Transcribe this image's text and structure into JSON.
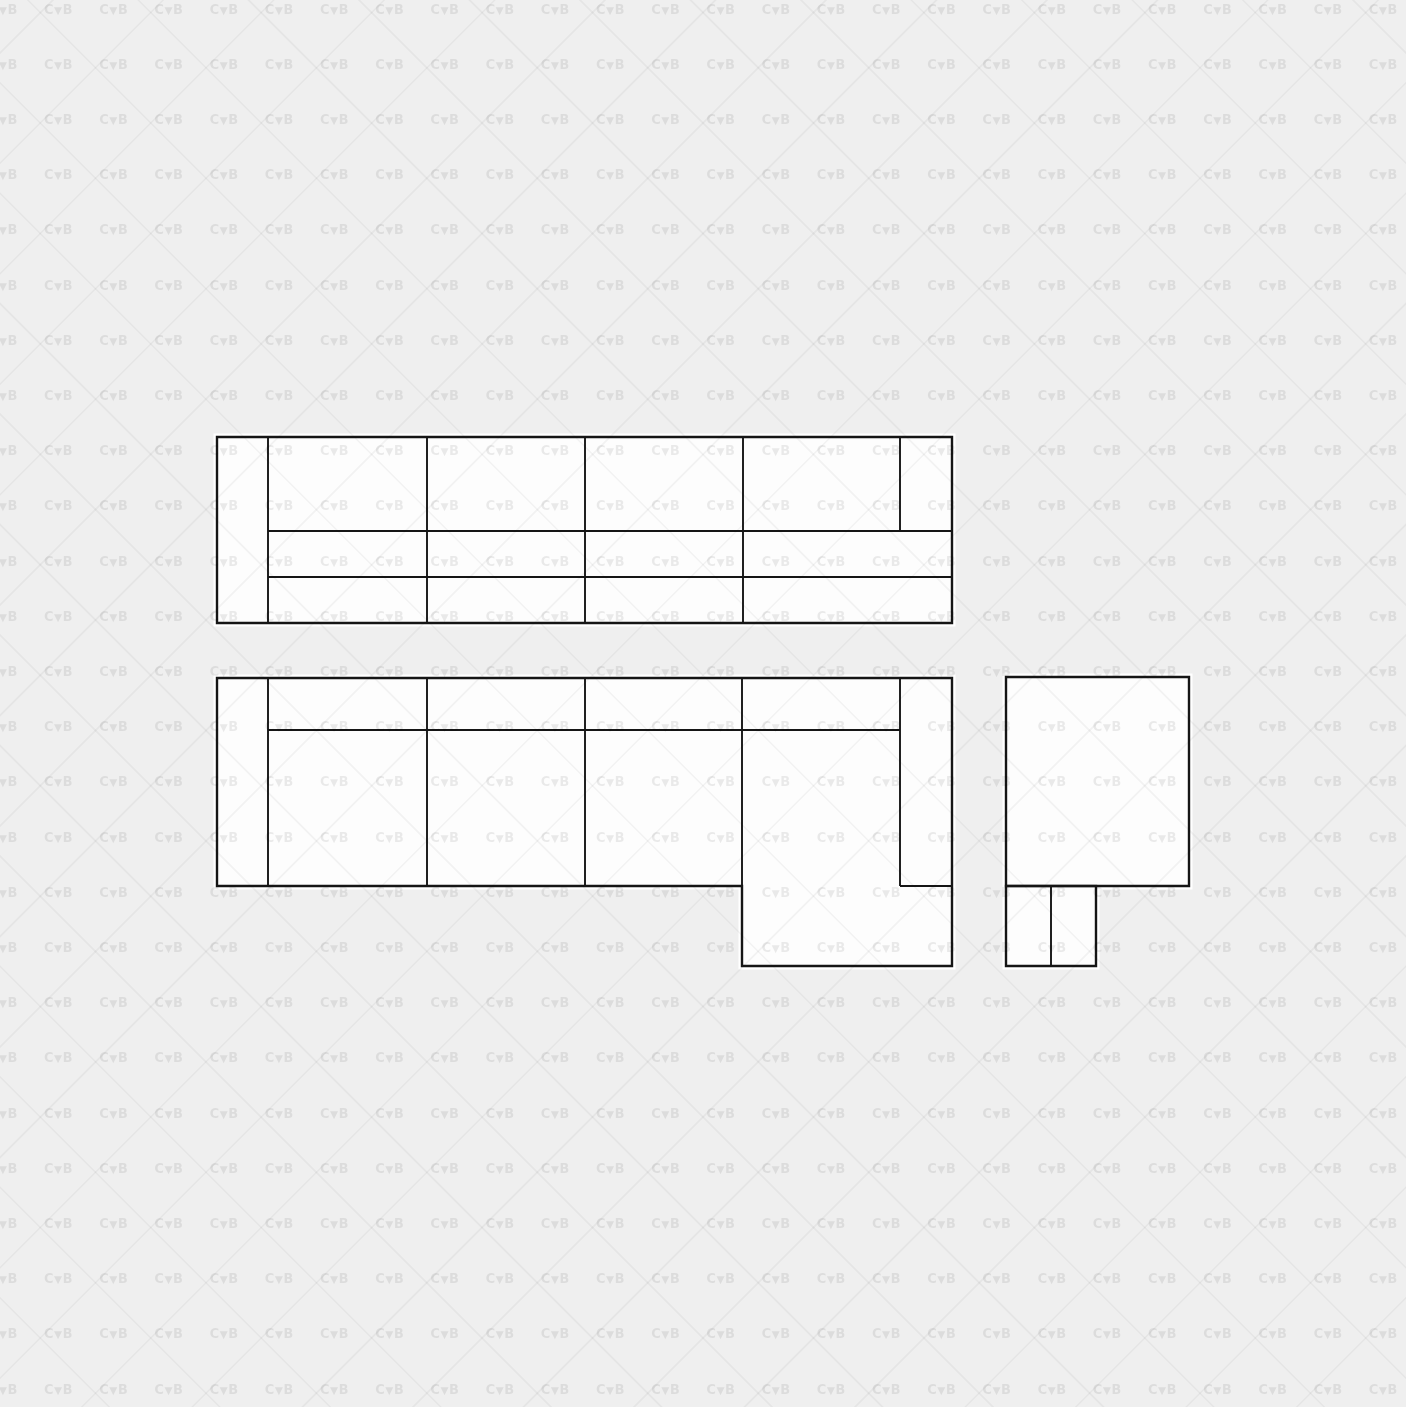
{
  "canvas": {
    "width": 1406,
    "height": 1407,
    "background_color": "#efefef"
  },
  "watermark": {
    "text": "CVB",
    "display_glyphs": [
      "C",
      "▼",
      "B"
    ],
    "text_color": "rgba(0,0,0,0.08)",
    "diagonal_line_color": "rgba(0,0,0,0.042)",
    "tile_size": 55.2,
    "origin_x": -11.2,
    "origin_y": 4.6,
    "diagonal_spacing": 78.1,
    "diagonal_line_width": 1.6
  },
  "drawing": {
    "stroke_color": "#151515",
    "fill_color": "#fdfdfd",
    "halo_color": "#ffffff",
    "outer_stroke_width": 2.4,
    "inner_stroke_width": 1.9,
    "halo_width": 7,
    "blocks": [
      {
        "name": "straight-sofa-top-view",
        "outline": [
          [
            217,
            437
          ],
          [
            952,
            437
          ],
          [
            952,
            623
          ],
          [
            217,
            623
          ]
        ],
        "inner_lines": [
          [
            268,
            437,
            268,
            623
          ],
          [
            427,
            437,
            427,
            623
          ],
          [
            585,
            437,
            585,
            623
          ],
          [
            743,
            437,
            743,
            623
          ],
          [
            900,
            437,
            900,
            531
          ],
          [
            268,
            531,
            952,
            531
          ],
          [
            268,
            577,
            952,
            577
          ]
        ]
      },
      {
        "name": "corner-sofa-chaise-top-view",
        "outline": [
          [
            217,
            678
          ],
          [
            952,
            678
          ],
          [
            952,
            966
          ],
          [
            742,
            966
          ],
          [
            742,
            886
          ],
          [
            217,
            886
          ]
        ],
        "inner_lines": [
          [
            268,
            678,
            268,
            886
          ],
          [
            427,
            678,
            427,
            886
          ],
          [
            585,
            678,
            585,
            886
          ],
          [
            742,
            678,
            742,
            886
          ],
          [
            900,
            678,
            900,
            886
          ],
          [
            268,
            730,
            900,
            730
          ],
          [
            900,
            886,
            952,
            886
          ]
        ]
      },
      {
        "name": "armchair-top-view",
        "outline": [
          [
            1006,
            677
          ],
          [
            1189,
            677
          ],
          [
            1189,
            886
          ],
          [
            1006,
            886
          ]
        ],
        "inner_lines": []
      },
      {
        "name": "ottoman-pair-top-view",
        "outline": [
          [
            1006,
            886
          ],
          [
            1096,
            886
          ],
          [
            1096,
            966
          ],
          [
            1006,
            966
          ]
        ],
        "inner_lines": [
          [
            1051,
            886,
            1051,
            966
          ]
        ]
      }
    ]
  }
}
